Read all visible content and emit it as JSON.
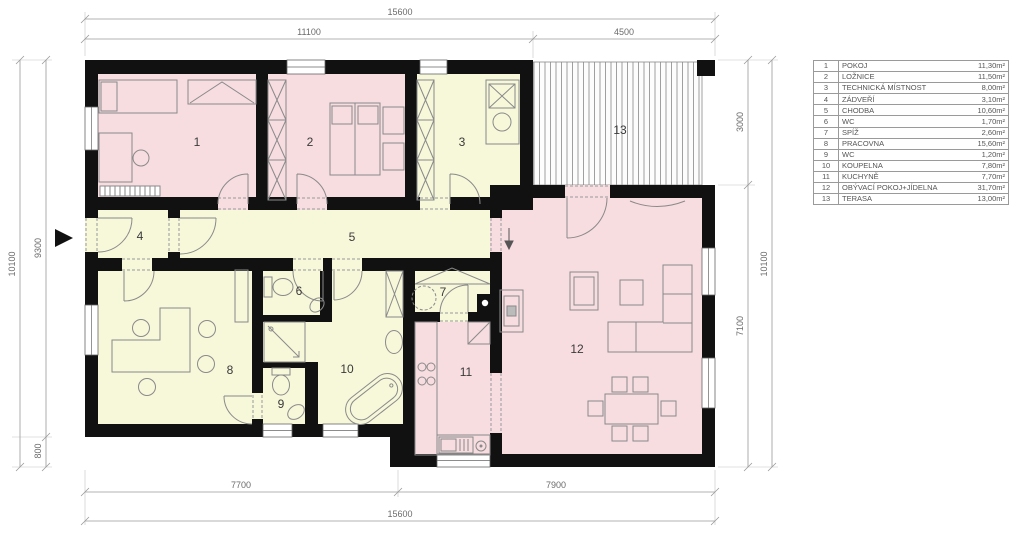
{
  "legend": {
    "rows": [
      {
        "num": "1",
        "name": "POKOJ",
        "area": "11,30m²"
      },
      {
        "num": "2",
        "name": "LOŽNICE",
        "area": "11,50m²"
      },
      {
        "num": "3",
        "name": "TECHNICKÁ MÍSTNOST",
        "area": "8,00m²"
      },
      {
        "num": "4",
        "name": "ZÁDVEŘÍ",
        "area": "3,10m²"
      },
      {
        "num": "5",
        "name": "CHODBA",
        "area": "10,60m²"
      },
      {
        "num": "6",
        "name": "WC",
        "area": "1,70m²"
      },
      {
        "num": "7",
        "name": "SPÍŽ",
        "area": "2,60m²"
      },
      {
        "num": "8",
        "name": "PRACOVNA",
        "area": "15,60m²"
      },
      {
        "num": "9",
        "name": "WC",
        "area": "1,20m²"
      },
      {
        "num": "10",
        "name": "KOUPELNA",
        "area": "7,80m²"
      },
      {
        "num": "11",
        "name": "KUCHYNĚ",
        "area": "7,70m²"
      },
      {
        "num": "12",
        "name": "OBÝVACÍ POKOJ+JÍDELNA",
        "area": "31,70m²"
      },
      {
        "num": "13",
        "name": "TERASA",
        "area": "13,00m²"
      }
    ]
  },
  "dims": {
    "top_total": "15600",
    "top_main": "11100",
    "top_terrace": "4500",
    "bottom_left": "7700",
    "bottom_right": "7900",
    "bottom_total": "15600",
    "left_total": "10100",
    "left_main": "9300",
    "left_offset": "800",
    "right_terrace": "3000",
    "right_living": "7100",
    "right_total": "10100"
  },
  "colors": {
    "room_pink": "#f7dce0",
    "room_yellow": "#f7f7da",
    "wall": "#111111"
  }
}
